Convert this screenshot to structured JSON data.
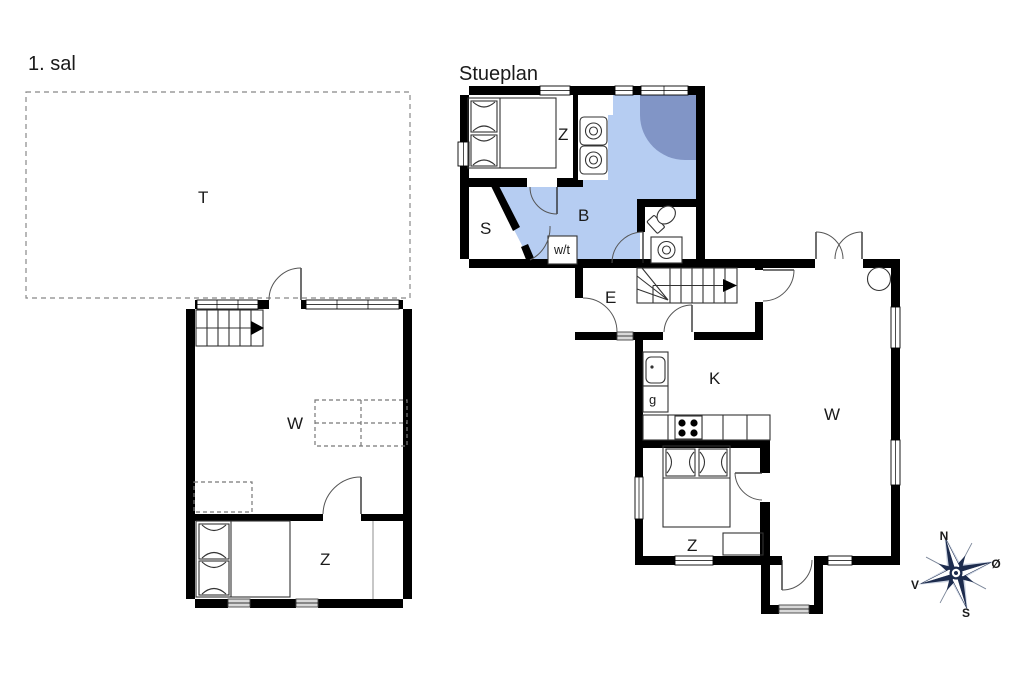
{
  "first_floor": {
    "title": "1. sal",
    "rooms": {
      "loft": "T",
      "living": "W",
      "bedroom": "Z"
    }
  },
  "ground_floor": {
    "title": "Stueplan",
    "rooms": {
      "bedroom_top": "Z",
      "hall": "S",
      "bathroom": "B",
      "washer_dryer": "w/t",
      "entry": "E",
      "kitchen": "K",
      "guest": "g",
      "living": "W",
      "bedroom_bottom": "Z"
    }
  },
  "compass": {
    "north": "N",
    "east": "Ø",
    "south": "S",
    "west": "V"
  },
  "colors": {
    "bathroom_fill": "#b6cdf2",
    "shower_fill": "#8195c6",
    "compass_dark": "#1c2b4d",
    "compass_light": "#ccd4e2"
  }
}
